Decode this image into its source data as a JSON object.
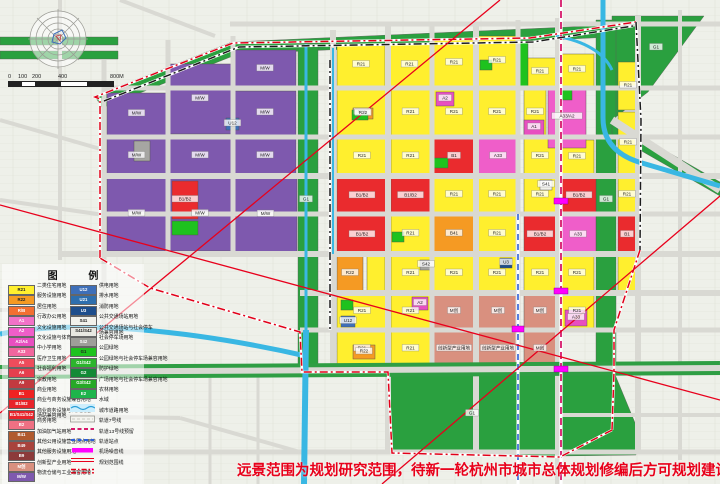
{
  "note": {
    "text": "远景范围为规划研究范围，待新一轮杭州市城市总体规划修编后方可规划建设。",
    "color": "#e8001a"
  },
  "legend": {
    "title": "图 例",
    "left": [
      {
        "code": "R21",
        "color": "#ffef2e",
        "dark": true,
        "label": "二类住宅用地"
      },
      {
        "code": "R22",
        "color": "#f59a23",
        "dark": true,
        "label": "服务设施用地"
      },
      {
        "code": "R/B",
        "color": "#f26f32",
        "label": "居住用地"
      },
      {
        "code": "A1",
        "color": "#f272c8",
        "label": "行政办公用地"
      },
      {
        "code": "A2",
        "color": "#ef5ec9",
        "label": "文化设施用地"
      },
      {
        "code": "A2/A4",
        "color": "#e84fc0",
        "label": "文化设施与体育兼容用地"
      },
      {
        "code": "A33",
        "color": "#f0669e",
        "label": "中小学用地"
      },
      {
        "code": "A5",
        "color": "#ed4c5c",
        "label": "医疗卫生用地"
      },
      {
        "code": "A6",
        "color": "#e63f4e",
        "label": "社会福利用地"
      },
      {
        "code": "A9",
        "color": "#c23a40",
        "label": "宗教用地"
      },
      {
        "code": "B1",
        "color": "#ee2222",
        "label": "商业用地"
      },
      {
        "code": "B1/B2",
        "color": "#e8232a",
        "label": "商业与商务设施兼容用地"
      },
      {
        "code": "B1/S41/S42",
        "color": "#e8232a",
        "label": "商业商务设施与公共交通\n场站兼容用地"
      },
      {
        "code": "B2",
        "color": "#ef7083",
        "label": "商务用地"
      },
      {
        "code": "B41",
        "color": "#b05a2e",
        "label": "加油加气站用地"
      },
      {
        "code": "B49",
        "color": "#a8433c",
        "label": "其他公用设施营业网点用地"
      },
      {
        "code": "B9",
        "color": "#8c3a3a",
        "label": "其他服务设施用地"
      },
      {
        "code": "M创",
        "color": "#d9907f",
        "label": "创新型产业用地"
      },
      {
        "code": "M/W",
        "color": "#7e59ae",
        "label": "物流仓储与工业兼容用地"
      }
    ],
    "right": [
      {
        "code": "U12",
        "color": "#3e6fb8",
        "label": "供电用地"
      },
      {
        "code": "U21",
        "color": "#2e6fae",
        "label": "排水用地"
      },
      {
        "code": "U3",
        "color": "#1e4e8c",
        "label": "消防用地"
      },
      {
        "code": "S41",
        "color": "#f2f2ec",
        "dark": true,
        "label": "公共交通场站用地"
      },
      {
        "code": "S41/S42",
        "color": "#e8e8e2",
        "dark": true,
        "label": "公共交通场站与社会停车\n场兼容用地"
      },
      {
        "code": "S42",
        "color": "#9e9e9a",
        "label": "社会停车场用地"
      },
      {
        "code": "G1",
        "color": "#1ec21e",
        "dark": true,
        "label": "公园绿地"
      },
      {
        "code": "G1/S42",
        "color": "#2cb42c",
        "label": "公园绿地与社会停车场兼容用地"
      },
      {
        "code": "G2",
        "color": "#128a36",
        "label": "防护绿地"
      },
      {
        "code": "G3/S42",
        "color": "#27a827",
        "label": "广场用地与社会停车场兼容用地"
      },
      {
        "code": "E2",
        "color": "#1eb44b",
        "label": "农林用地"
      },
      {
        "sym": "water",
        "label": "水域"
      },
      {
        "sym": "road",
        "label": "城市道路用地"
      },
      {
        "sym": "rail7",
        "label": "轨道7号线"
      },
      {
        "sym": "rail13",
        "label": "轨道13号线预留"
      },
      {
        "sym": "station",
        "label": "轨道站点"
      },
      {
        "sym": "noise",
        "label": "机场噪音线"
      },
      {
        "sym": "boundary",
        "label": "规划范围线"
      }
    ]
  },
  "scalebar": {
    "labels": [
      {
        "t": "0",
        "x": 0
      },
      {
        "t": "100",
        "x": 10
      },
      {
        "t": "200",
        "x": 24
      },
      {
        "t": "400",
        "x": 50
      },
      {
        "t": "800M",
        "x": 102
      }
    ],
    "segments": [
      {
        "x": 0,
        "w": 13
      },
      {
        "x": 26,
        "w": 26
      },
      {
        "x": 78,
        "w": 26
      }
    ],
    "width": 104
  },
  "map": {
    "palette": {
      "Y": "#ffef2e",
      "ORN": "#f59a23",
      "RB": "#f26f32",
      "MA": "#ef5ec9",
      "MA2": "#e84fc0",
      "PK": "#f0669e",
      "RED": "#ea2b2e",
      "DRD": "#c23a40",
      "BRN": "#b05a2e",
      "SAL": "#d9907f",
      "PUR": "#7e59ae",
      "GRY": "#a6a6a2",
      "WHT": "#f2f2ec",
      "BLU": "#3e6fb8",
      "NVY": "#1e4e8c",
      "G": "#2aa03f",
      "GB": "#1ec21e"
    },
    "polygons": [
      {
        "pts": "95,96 232,42 636,24 636,36 238,54 102,108",
        "c": "G"
      },
      {
        "pts": "612,16 704,16 648,92 612,120",
        "c": "G"
      },
      {
        "pts": "298,44 318,44 318,370 298,370",
        "c": "G"
      },
      {
        "pts": "596,20 616,20 616,372 596,372",
        "c": "G"
      },
      {
        "pts": "388,372 560,372 558,456 392,452",
        "c": "G"
      },
      {
        "pts": "560,372 614,372 638,430 636,455 558,456",
        "c": "G"
      },
      {
        "pts": "0,37 118,37 118,45 0,45",
        "c": "G"
      },
      {
        "pts": "0,51 118,51 118,59 0,59",
        "c": "G"
      },
      {
        "pts": "612,120 720,182 720,196 612,134",
        "c": "G"
      }
    ],
    "blocks": [
      [
        107,
        93,
        59,
        42,
        "PUR",
        "M/W"
      ],
      [
        169,
        64,
        62,
        70,
        "PUR",
        "M/W"
      ],
      [
        234,
        50,
        62,
        38,
        "PUR",
        "M/W"
      ],
      [
        107,
        138,
        59,
        36,
        "PUR",
        "M/W"
      ],
      [
        169,
        138,
        62,
        36,
        "PUR",
        "M/W"
      ],
      [
        234,
        91,
        62,
        44,
        "PUR",
        "M/W"
      ],
      [
        234,
        138,
        62,
        36,
        "PUR",
        "M/W"
      ],
      [
        107,
        177,
        59,
        74,
        "PUR",
        "M/W"
      ],
      [
        169,
        177,
        62,
        74,
        "PUR",
        "M/W"
      ],
      [
        234,
        177,
        63,
        75,
        "PUR",
        "M/W"
      ],
      [
        172,
        181,
        26,
        38,
        "RED",
        "B1/B2"
      ],
      [
        172,
        221,
        26,
        14,
        "GB",
        ""
      ],
      [
        134,
        141,
        16,
        20,
        "GRY",
        ""
      ],
      [
        226,
        118,
        13,
        12,
        "BLU",
        "U12"
      ],
      [
        337,
        44,
        48,
        42,
        "Y",
        "R21"
      ],
      [
        389,
        44,
        41,
        42,
        "Y",
        "R21"
      ],
      [
        434,
        40,
        40,
        46,
        "Y",
        "R21"
      ],
      [
        478,
        36,
        38,
        50,
        "Y",
        "R21"
      ],
      [
        524,
        58,
        32,
        28,
        "Y",
        "R21"
      ],
      [
        560,
        54,
        34,
        32,
        "Y",
        "R21"
      ],
      [
        618,
        62,
        20,
        48,
        "Y",
        "R21"
      ],
      [
        618,
        112,
        20,
        62,
        "Y",
        "R21"
      ],
      [
        618,
        178,
        18,
        34,
        "Y",
        "R21"
      ],
      [
        618,
        216,
        18,
        38,
        "RED",
        "B1"
      ],
      [
        618,
        256,
        18,
        35,
        "Y",
        ""
      ],
      [
        337,
        90,
        50,
        45,
        "Y",
        "R21"
      ],
      [
        391,
        90,
        39,
        45,
        "Y",
        "R21"
      ],
      [
        434,
        90,
        40,
        45,
        "Y",
        "R21"
      ],
      [
        478,
        90,
        38,
        45,
        "Y",
        "R21"
      ],
      [
        524,
        90,
        22,
        45,
        "Y",
        "R21"
      ],
      [
        337,
        139,
        50,
        35,
        "Y",
        "R21"
      ],
      [
        391,
        139,
        39,
        35,
        "Y",
        "R21"
      ],
      [
        524,
        139,
        32,
        35,
        "Y",
        "R21"
      ],
      [
        560,
        140,
        34,
        34,
        "Y",
        "R21"
      ],
      [
        434,
        178,
        40,
        34,
        "Y",
        "R21"
      ],
      [
        478,
        178,
        38,
        34,
        "Y",
        "R21"
      ],
      [
        524,
        178,
        32,
        34,
        "Y",
        "R21"
      ],
      [
        391,
        216,
        39,
        36,
        "Y",
        "R21"
      ],
      [
        478,
        216,
        38,
        36,
        "Y",
        "R21"
      ],
      [
        367,
        256,
        18,
        35,
        "Y",
        ""
      ],
      [
        391,
        256,
        39,
        35,
        "Y",
        "R21"
      ],
      [
        434,
        256,
        40,
        35,
        "Y",
        "R21"
      ],
      [
        478,
        256,
        38,
        35,
        "Y",
        "R21"
      ],
      [
        524,
        256,
        32,
        35,
        "Y",
        "R21"
      ],
      [
        560,
        256,
        34,
        35,
        "Y",
        "R21"
      ],
      [
        337,
        295,
        50,
        33,
        "Y",
        "R21"
      ],
      [
        391,
        295,
        39,
        33,
        "Y",
        "R21"
      ],
      [
        560,
        295,
        34,
        33,
        "Y",
        "R21"
      ],
      [
        337,
        332,
        50,
        34,
        "Y",
        "R21"
      ],
      [
        391,
        332,
        39,
        34,
        "Y",
        "R21"
      ],
      [
        548,
        86,
        38,
        62,
        "MA",
        "A33/A2"
      ],
      [
        478,
        139,
        40,
        35,
        "MA",
        "A33"
      ],
      [
        436,
        92,
        18,
        14,
        "MA2",
        "A2"
      ],
      [
        560,
        216,
        36,
        38,
        "MA",
        "A33"
      ],
      [
        412,
        297,
        16,
        13,
        "MA2",
        "A2"
      ],
      [
        565,
        310,
        22,
        16,
        "MA2",
        "A33"
      ],
      [
        524,
        120,
        20,
        15,
        "MA2",
        "A1"
      ],
      [
        337,
        178,
        50,
        36,
        "RED",
        "B1/B2"
      ],
      [
        391,
        178,
        39,
        36,
        "RED",
        "B1/B2"
      ],
      [
        337,
        216,
        50,
        38,
        "RED",
        "B1/B2"
      ],
      [
        524,
        216,
        32,
        38,
        "RED",
        "B1/B2"
      ],
      [
        562,
        178,
        34,
        36,
        "RED",
        "B1/B2"
      ],
      [
        434,
        139,
        40,
        35,
        "RED",
        "B1"
      ],
      [
        434,
        216,
        40,
        36,
        "ORN",
        "B41"
      ],
      [
        337,
        256,
        26,
        35,
        "ORN",
        "R22"
      ],
      [
        353,
        108,
        20,
        11,
        "ORN",
        "R22"
      ],
      [
        353,
        345,
        22,
        14,
        "ORN",
        "R22"
      ],
      [
        434,
        295,
        40,
        33,
        "SAL",
        "M创"
      ],
      [
        478,
        295,
        40,
        33,
        "SAL",
        "M创"
      ],
      [
        524,
        295,
        32,
        33,
        "SAL",
        "M创"
      ],
      [
        434,
        332,
        40,
        34,
        "SAL",
        "创新型产业用地"
      ],
      [
        478,
        332,
        40,
        34,
        "SAL",
        "创新型产业用地"
      ],
      [
        524,
        332,
        32,
        34,
        "SAL",
        "M创"
      ],
      [
        341,
        316,
        14,
        11,
        "BLU",
        "U12"
      ],
      [
        500,
        258,
        12,
        10,
        "NVY",
        "U3"
      ],
      [
        420,
        260,
        12,
        10,
        "GRY",
        "S42"
      ],
      [
        540,
        180,
        12,
        10,
        "WHT",
        "S41"
      ],
      [
        352,
        110,
        16,
        10,
        "GB",
        ""
      ],
      [
        434,
        158,
        14,
        10,
        "GB",
        ""
      ],
      [
        560,
        90,
        12,
        10,
        "GB",
        ""
      ],
      [
        392,
        232,
        12,
        10,
        "GB",
        ""
      ],
      [
        341,
        300,
        12,
        10,
        "GB",
        ""
      ],
      [
        480,
        60,
        12,
        10,
        "GB",
        ""
      ],
      [
        520,
        40,
        8,
        46,
        "GB",
        ""
      ]
    ],
    "roads": {
      "v": [
        [
          168,
          40,
          254,
          5
        ],
        [
          233,
          36,
          254,
          5
        ],
        [
          333,
          30,
          368,
          6
        ],
        [
          388,
          26,
          452,
          6
        ],
        [
          432,
          24,
          368,
          5
        ],
        [
          476,
          22,
          452,
          6
        ],
        [
          518,
          20,
          368,
          5
        ],
        [
          558,
          18,
          484,
          6
        ],
        [
          638,
          16,
          452,
          6
        ],
        [
          680,
          10,
          460,
          4
        ],
        [
          60,
          0,
          260,
          4
        ],
        [
          104,
          60,
          330,
          5
        ],
        [
          210,
          372,
          484,
          3
        ],
        [
          258,
          372,
          484,
          3
        ]
      ],
      "h": [
        [
          88,
          104,
          720,
          5
        ],
        [
          137,
          104,
          720,
          5
        ],
        [
          176,
          104,
          720,
          6
        ],
        [
          214,
          104,
          720,
          5
        ],
        [
          254,
          60,
          720,
          6
        ],
        [
          293,
          300,
          720,
          6
        ],
        [
          330,
          300,
          720,
          5
        ],
        [
          452,
          0,
          720,
          5
        ],
        [
          415,
          560,
          720,
          4
        ],
        [
          24,
          230,
          720,
          5
        ],
        [
          310,
          0,
          104,
          4
        ],
        [
          418,
          0,
          180,
          3
        ]
      ],
      "d": [
        [
          120,
          0,
          215,
          36,
          4
        ],
        [
          0,
          120,
          104,
          150,
          4
        ],
        [
          0,
          200,
          104,
          215,
          4
        ],
        [
          612,
          120,
          720,
          190,
          8
        ],
        [
          0,
          415,
          180,
          418,
          4
        ],
        [
          180,
          418,
          300,
          452,
          4
        ]
      ]
    },
    "boulevard": {
      "x1": 0,
      "y1": 372,
      "x2": 720,
      "y2": 368,
      "green": "#2f9e44",
      "gw": 14,
      "gray": "#d9d9d3",
      "rw": 6
    },
    "waters": [
      {
        "p": "M603,0 L603,118 Q603,152 642,163 L720,186",
        "w": 5
      },
      {
        "p": "M306,44 L306,330",
        "w": 3
      },
      {
        "p": "M306,330 L304,484",
        "w": 6
      },
      {
        "p": "M333,48 L333,254",
        "w": 2
      },
      {
        "p": "M0,334 C80,318 200,332 306,356",
        "w": 5
      },
      {
        "p": "M556,36 Q600,44 612,70",
        "w": 3
      }
    ],
    "rails": [
      {
        "p": "M561,0 L561,484",
        "c": "#d6186a",
        "dash": "7,4",
        "w": 1.8
      },
      {
        "p": "M518,214 L518,484",
        "c": "#2b5fd9",
        "dash": "6,4",
        "w": 1.6
      }
    ],
    "stations": [
      [
        554,
        198,
        14,
        6
      ],
      [
        554,
        288,
        14,
        6
      ],
      [
        554,
        366,
        14,
        6
      ],
      [
        512,
        326,
        12,
        6
      ]
    ],
    "boundaries": [
      {
        "s": "red",
        "pts": "100,258 100,99 95,97 233,43 530,38 636,22"
      },
      {
        "s": "black",
        "pts": "104,101 239,47 533,42 633,26"
      },
      {
        "s": "black",
        "pts": "636,22 641,120 640,250"
      },
      {
        "s": "black",
        "pts": "330,60 330,330"
      },
      {
        "s": "red",
        "pts": "640,250 614,330 614,372 612,430"
      },
      {
        "s": "red",
        "pts": "612,430 560,457 392,453 388,372 302,372 300,332 150,288 100,258"
      }
    ],
    "noise": [
      "0,413 500,0",
      "382,484 720,196",
      "0,205 720,400"
    ],
    "labels": [
      {
        "x": 472,
        "y": 414,
        "t": "G1"
      },
      {
        "x": 306,
        "y": 200,
        "t": "G1"
      },
      {
        "x": 606,
        "y": 200,
        "t": "G1"
      },
      {
        "x": 656,
        "y": 48,
        "t": "G1"
      }
    ]
  }
}
